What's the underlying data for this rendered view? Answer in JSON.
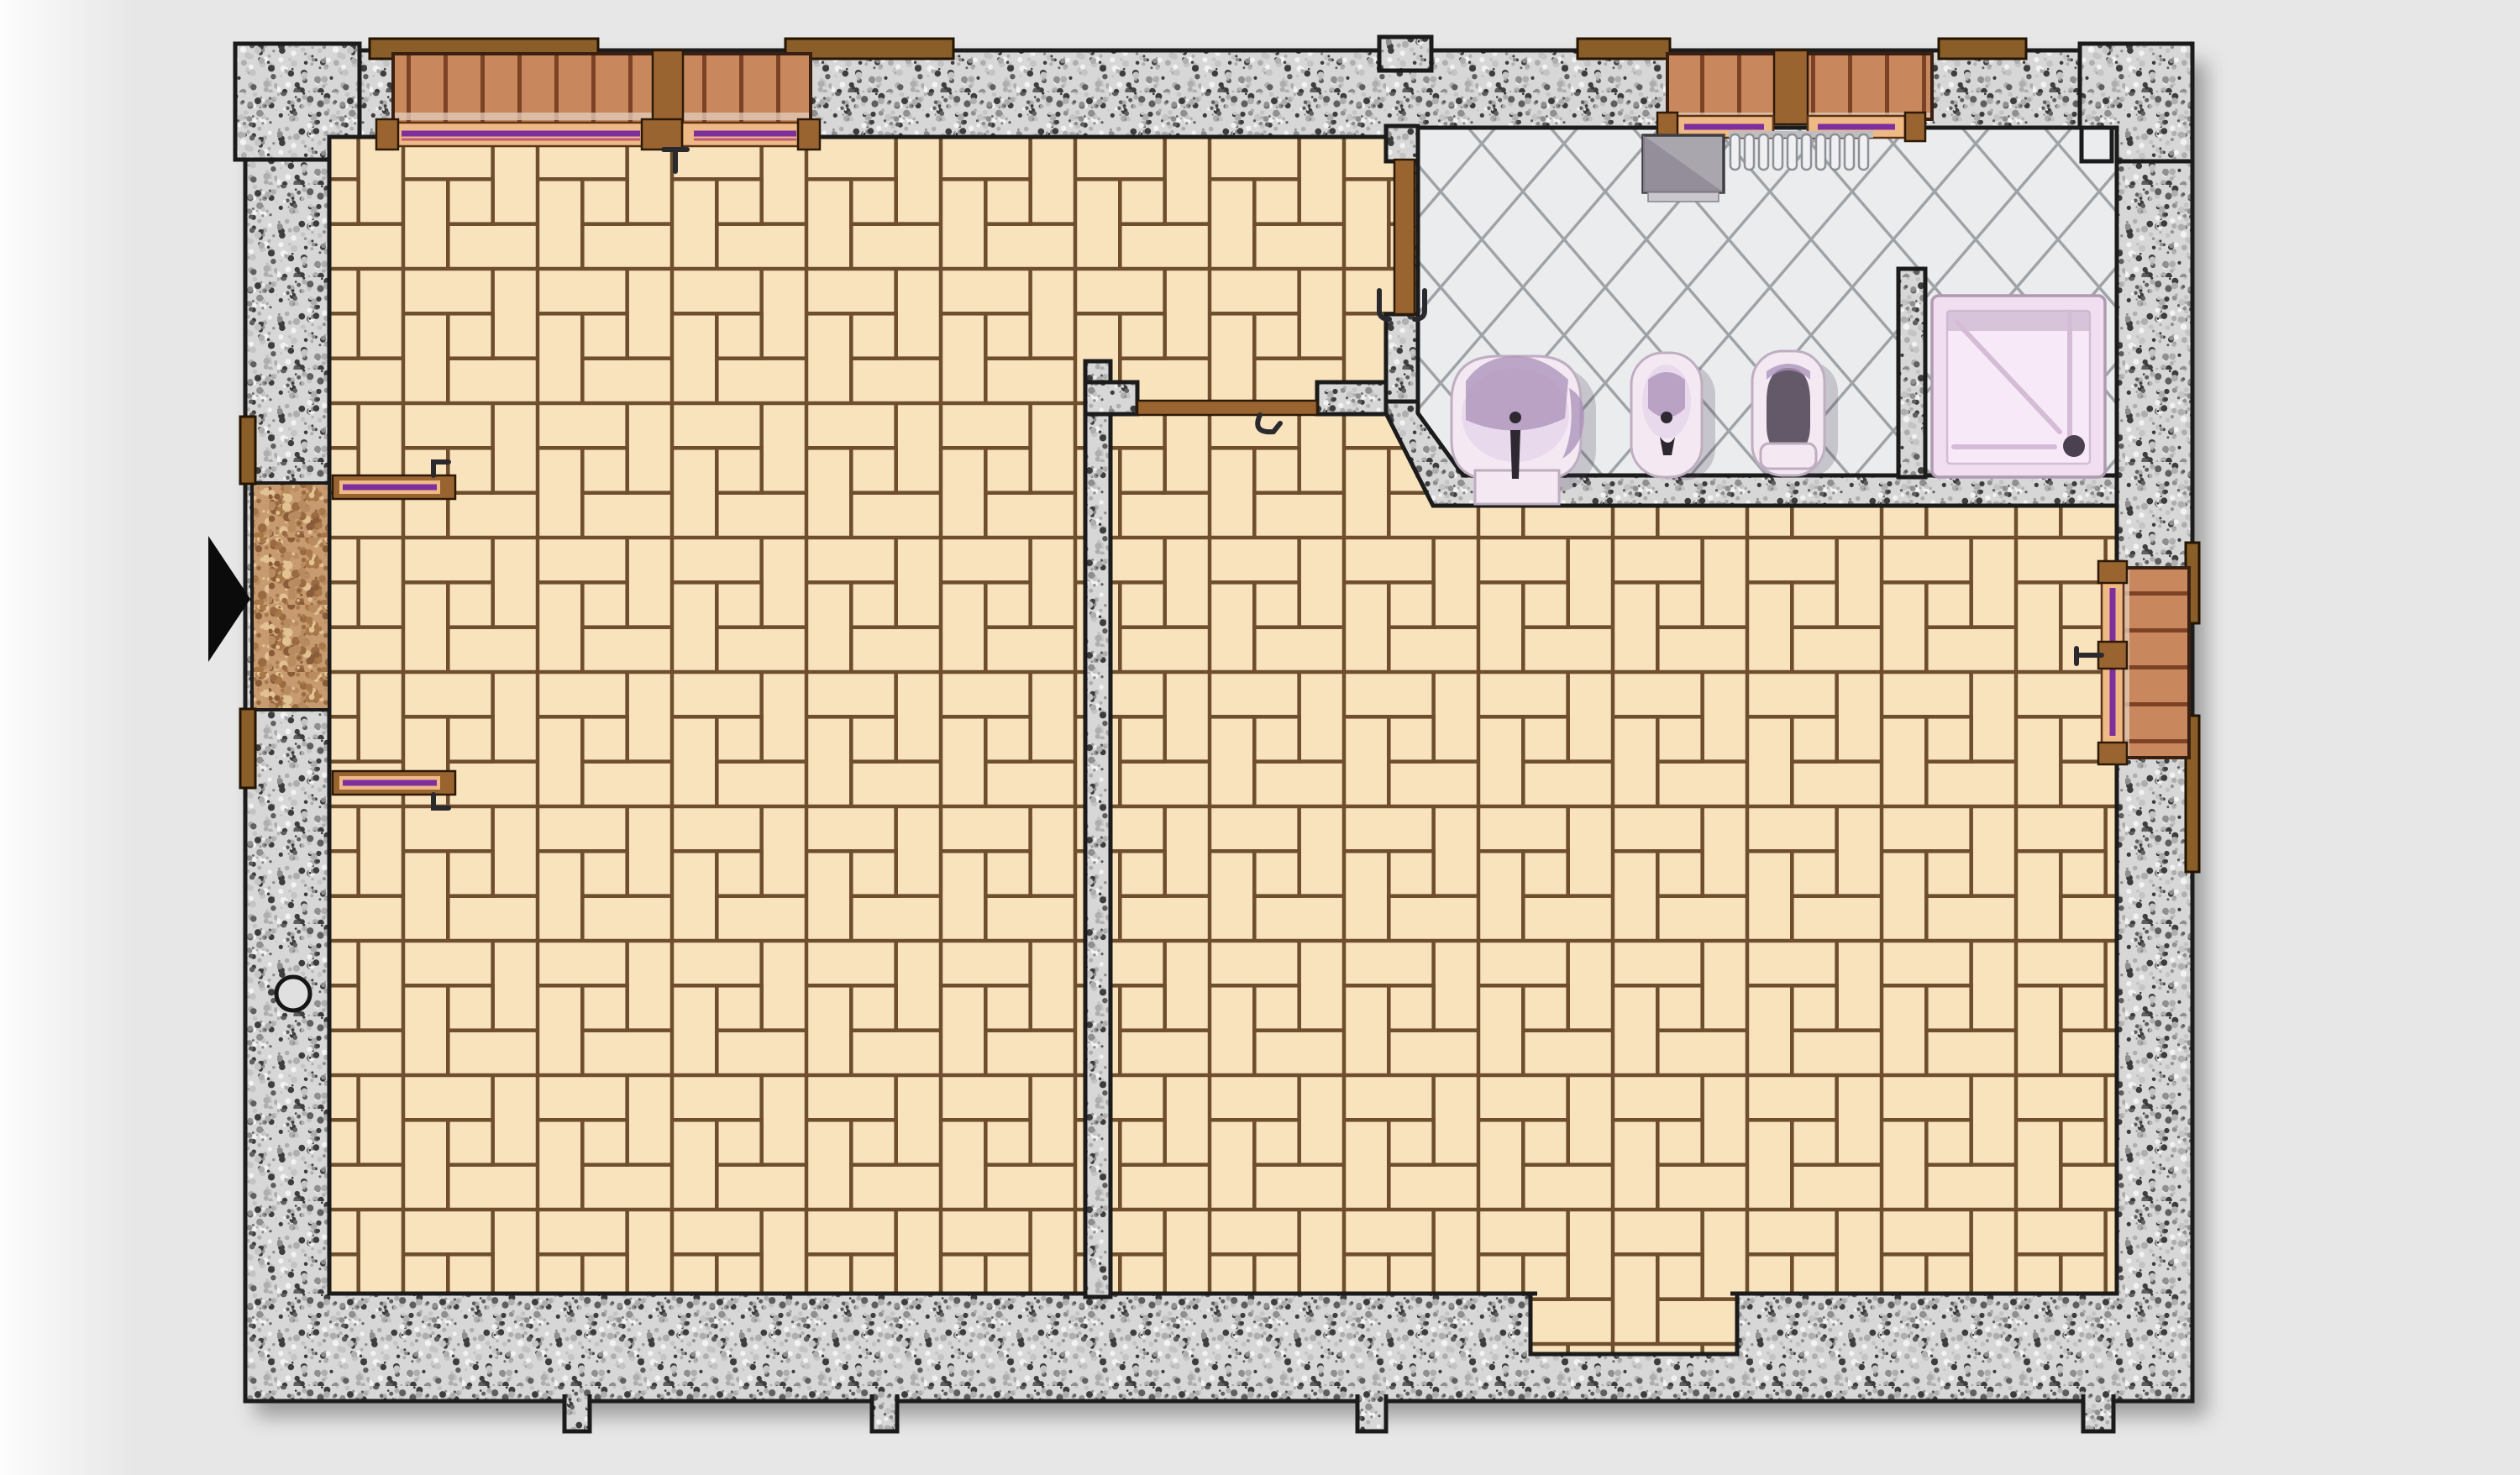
{
  "meta": {
    "kind": "architectural-floor-plan",
    "view": "top-down plan of an apartment floor with two parquet rooms and a tiled bathroom"
  },
  "colors": {
    "background": "#e8e8e8",
    "ink": "#1b1b1b",
    "granite_base": "#d7d7d7",
    "granite_speckles": [
      "#c4c4c4",
      "#aeaeae",
      "#8f8f8f",
      "#5f5f5f",
      "#f2f2f2",
      "#3d3d3d"
    ],
    "parquet_fill": "#f8e3bd",
    "parquet_joint": "#6e4e2e",
    "bathtile_base": "#ebecee",
    "bathtile_line": "#9ea3a7",
    "brick_fill": "#c8875c",
    "brick_joint": "#7c4226",
    "brick_mortar": "#e3cdbd",
    "frame_tan": "#efb985",
    "stripe_purple": "#7d2f9e",
    "stripe_pink": "#c05a7a",
    "wood_brown": "#9a6430",
    "lintel_brown": "#8a5e28",
    "stone_base": "#c79a6f",
    "stone_speckles": [
      "#a87848",
      "#8a5c38",
      "#e2c193",
      "#9a6b42",
      "#b98c60"
    ],
    "fixture_body": "#f4e9f2",
    "fixture_stroke": "#bfadc1",
    "fixture_inner": "#e9d9ec",
    "fixture_shade": "#a98fb8",
    "fixture_dark": "#4a4050",
    "shower_tray": "#f1dff1",
    "shower_tray_inner": "#f7e9f7",
    "shower_tray_line": "#d5bcd6",
    "box_gray": "#aaa6ae"
  },
  "legend": {
    "rooms": [
      {
        "id": "room-left",
        "floor": "parquet herringbone-square"
      },
      {
        "id": "room-right",
        "floor": "parquet herringbone-square"
      },
      {
        "id": "bathroom",
        "floor": "diagonal ceramic tile"
      }
    ],
    "fixtures": [
      {
        "id": "washbasin",
        "room": "bathroom"
      },
      {
        "id": "bidet",
        "room": "bathroom"
      },
      {
        "id": "toilet",
        "room": "bathroom"
      },
      {
        "id": "shower-tray",
        "room": "bathroom",
        "detail": "drain at bottom-right"
      },
      {
        "id": "radiator",
        "room": "bathroom",
        "fins": 10
      },
      {
        "id": "duct-box",
        "room": "bathroom"
      }
    ],
    "windows": [
      {
        "id": "window-top-left",
        "leaves": 2
      },
      {
        "id": "window-bathroom-top",
        "leaves": 2
      },
      {
        "id": "window-right",
        "leaves": 1
      }
    ],
    "doors": [
      {
        "id": "entrance-double-door",
        "wall": "left",
        "leaves": 2
      },
      {
        "id": "interior-door",
        "between": [
          "room-left",
          "room-right"
        ]
      },
      {
        "id": "bathroom-door",
        "between": [
          "room-left",
          "bathroom"
        ]
      }
    ],
    "annotations": [
      {
        "id": "entrance-arrow",
        "meaning": "entry direction marker"
      },
      {
        "id": "wall-circle",
        "meaning": "round duct in left wall"
      },
      {
        "id": "wall-niche-square",
        "meaning": "small square duct in top-right corner"
      }
    ]
  }
}
